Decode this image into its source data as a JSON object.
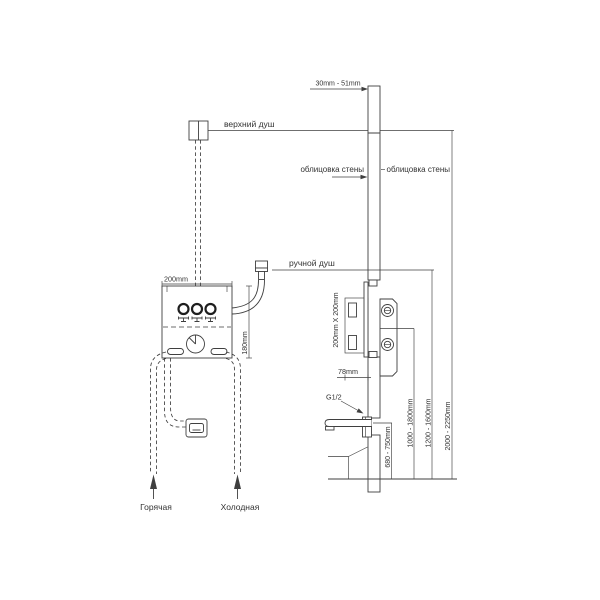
{
  "diagram": {
    "kind": "concealed-shower-installation-diagram",
    "labels": {
      "top_shower": "верхний душ",
      "hand_shower": "ручной душ",
      "wall_cladding_left": "облицовка стены",
      "wall_cladding_right": "облицовка стены",
      "hot_supply": "Горячая",
      "cold_supply": "Холодная",
      "spout_thread": "G1/2"
    },
    "dimensions": {
      "cladding_thickness": "30mm - 51mm",
      "box_width": "200mm",
      "box_height": "180mm",
      "rough_in_box": "200mm X 200mm",
      "box_depth": "78mm",
      "spout_height": "680 - 750mm",
      "mixer_height": "1000 - 1800mm",
      "hand_shower_height": "1200 - 1600mm",
      "head_shower_height": "2000 - 2250mm"
    },
    "colors": {
      "line": "#3f3f3f",
      "text": "#333333",
      "background": "#ffffff"
    }
  }
}
